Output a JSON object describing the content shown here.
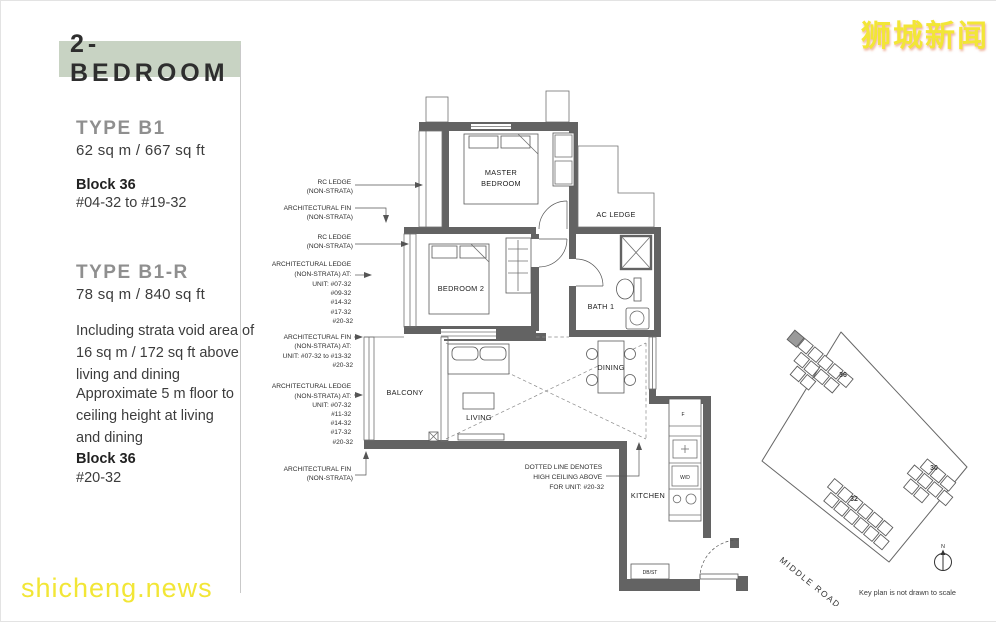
{
  "watermarks": {
    "logo": "狮城新闻",
    "site": "shicheng.news"
  },
  "header": {
    "title": "2-BEDROOM"
  },
  "sidebar": {
    "type1": {
      "name": "TYPE B1",
      "area": "62 sq m / 667 sq ft",
      "block_label": "Block 36",
      "units": "#04-32 to #19-32"
    },
    "type2": {
      "name": "TYPE B1-R",
      "area": "78 sq m / 840 sq ft",
      "note1": [
        "Including strata void area of",
        "16 sq m / 172 sq ft above",
        "living and dining"
      ],
      "note2": [
        "Approximate 5 m floor to",
        "ceiling height at living",
        "and dining"
      ],
      "block_label": "Block 36",
      "units": "#20-32"
    }
  },
  "plan": {
    "rooms": {
      "master_bedroom": [
        "MASTER",
        "BEDROOM"
      ],
      "bedroom2": "BEDROOM 2",
      "bath1": "BATH 1",
      "ac_ledge": "AC LEDGE",
      "balcony": "BALCONY",
      "living": "LIVING",
      "dining": "DINING",
      "kitchen": "KITCHEN",
      "fridge": "F",
      "washer_dryer": "W/D",
      "dbst": "DB/ST"
    },
    "callouts": [
      {
        "lines": [
          "RC LEDGE",
          "(NON-STRATA)"
        ]
      },
      {
        "lines": [
          "ARCHITECTURAL FIN",
          "(NON-STRATA)"
        ]
      },
      {
        "lines": [
          "RC LEDGE",
          "(NON-STRATA)"
        ]
      },
      {
        "lines": [
          "ARCHITECTURAL LEDGE",
          "(NON-STRATA) AT:",
          "UNIT: #07-32",
          "#09-32",
          "#14-32",
          "#17-32",
          "#20-32"
        ]
      },
      {
        "lines": [
          "ARCHITECTURAL FIN",
          "(NON-STRATA) AT:",
          "UNIT: #07-32 to #13-32",
          "#20-32"
        ]
      },
      {
        "lines": [
          "ARCHITECTURAL LEDGE",
          "(NON-STRATA) AT:",
          "UNIT: #07-32",
          "#11-32",
          "#14-32",
          "#17-32",
          "#20-32"
        ]
      },
      {
        "lines": [
          "ARCHITECTURAL FIN",
          "(NON-STRATA)"
        ]
      }
    ],
    "void_note": [
      "DOTTED LINE DENOTES",
      "HIGH CEILING ABOVE",
      "FOR UNIT: #20-32"
    ]
  },
  "keyplan": {
    "blocks": [
      "36",
      "32",
      "30"
    ],
    "road": "MIDDLE ROAD",
    "north": "N",
    "caption": "Key plan is not drawn to scale"
  }
}
